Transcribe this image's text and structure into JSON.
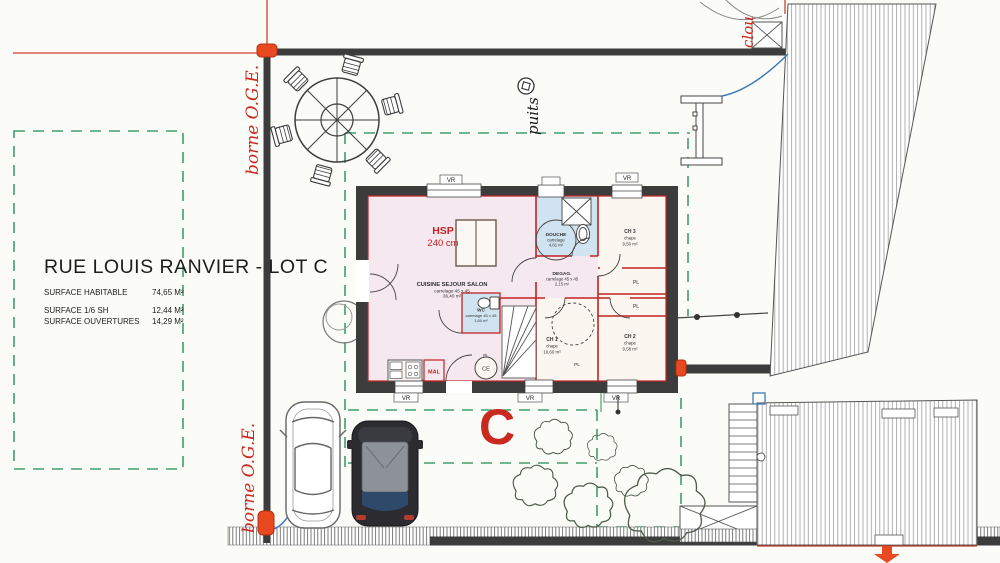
{
  "title_block": {
    "title": "RUE LOUIS RANVIER - LOT C",
    "rows": [
      {
        "label": "SURFACE HABITABLE",
        "value": "74,65 M²"
      },
      {
        "label": "SURFACE 1/6 SH",
        "value": "12,44 M²"
      },
      {
        "label": "SURFACE OUVERTURES",
        "value": "14,29 M²"
      }
    ]
  },
  "site": {
    "borne_top": "borne O.G.E.",
    "borne_bottom": "borne O.G.E.",
    "clou": "clou",
    "puits": "puits",
    "lot_letter": "C"
  },
  "floorplan": {
    "hsp_label": "HSP",
    "hsp_value": "240 cm",
    "rooms": {
      "salon": {
        "name": "CUISINE SEJOUR SALON",
        "material": "carrelage 45 x 45",
        "area": "36,40 m²"
      },
      "douche": {
        "name": "DOUCHE",
        "material": "carrelage",
        "area": "4,81 m²"
      },
      "ch3": {
        "name": "CH 3",
        "material": "chape",
        "area": "9,50 m²"
      },
      "degag": {
        "name": "DEGAG.",
        "material": "carrelage 45 x 45",
        "area": "2,15 m²"
      },
      "ch2": {
        "name": "CH 2",
        "material": "chape",
        "area": "9,58 m²"
      },
      "ch1": {
        "name": "CH 1",
        "material": "chape",
        "area": "10,60 m²"
      },
      "wc": {
        "name": "WC",
        "material": "carrelage 45 x 45",
        "area": "1,60 m²"
      }
    },
    "closet": "PL",
    "washing_machine": "MAL",
    "water_heater": "CE",
    "shutter": "VR"
  },
  "colors": {
    "red_annotation": "#c9291f",
    "marker_red": "#e8491f",
    "boundary_dark": "#3c3c3c",
    "setback_green": "#3f9e6e",
    "wall_red": "#c32222",
    "floor_pink": "#f5e8ee",
    "floor_blue": "#cfe4f0",
    "floor_chape": "#fbf6ef",
    "arrow_blue": "#4179b5"
  }
}
